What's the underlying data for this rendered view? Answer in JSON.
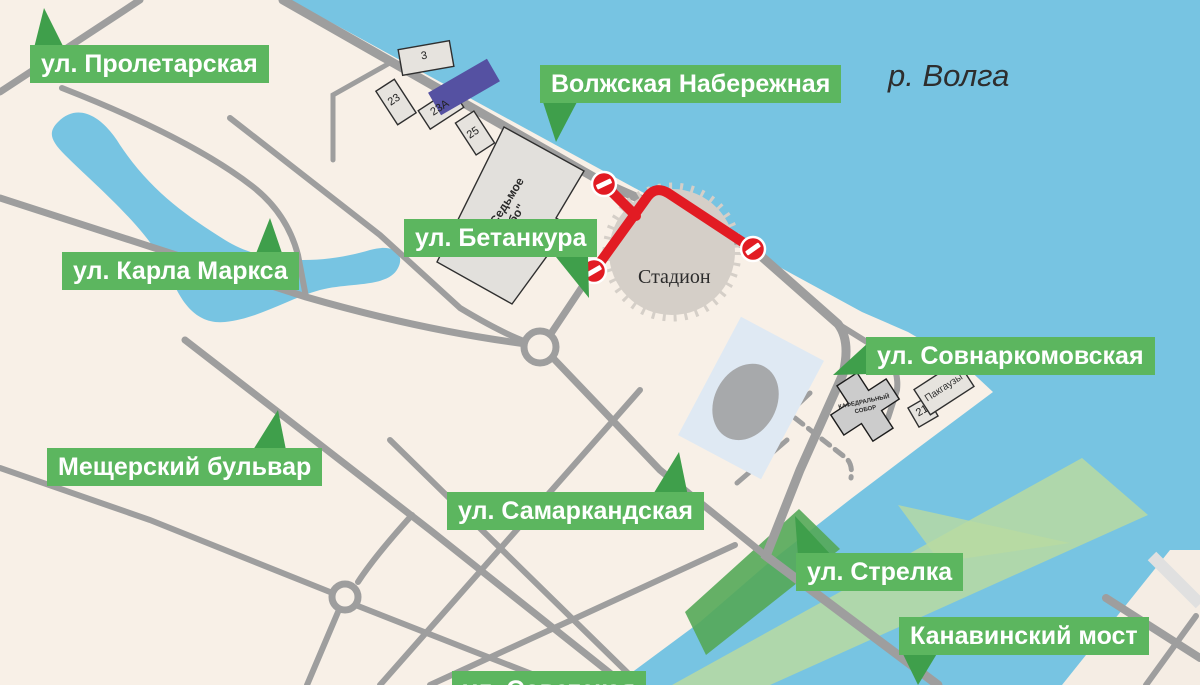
{
  "map": {
    "water_label": "р. Волга",
    "street_labels": [
      {
        "id": "proletarskaya",
        "text": "ул. Пролетарская"
      },
      {
        "id": "volzhskaya",
        "text": "Волжская Набережная"
      },
      {
        "id": "karla_marksa",
        "text": "ул. Карла Маркса"
      },
      {
        "id": "betankura",
        "text": "ул. Бетанкура"
      },
      {
        "id": "sovnarkomovskaya",
        "text": "ул. Совнаркомовская"
      },
      {
        "id": "meshchersky",
        "text": "Мещерский бульвар"
      },
      {
        "id": "samarkandskaya",
        "text": "ул. Самаркандская"
      },
      {
        "id": "strelka",
        "text": "ул. Стрелка"
      },
      {
        "id": "kanavinsky",
        "text": "Канавинский мост"
      },
      {
        "id": "sovetskaya",
        "text": "ул. Советская"
      }
    ],
    "poi": {
      "stadium": "Стадион",
      "mall_line1": "ТЦ \"Седьмое",
      "mall_line2": "небо\"",
      "cathedral_line1": "КАФЕДРАЛЬНЫЙ",
      "cathedral_line2": "СОБОР",
      "warehouses": "Пакгаузы"
    },
    "building_numbers": [
      "3",
      "23",
      "23А",
      "25",
      "21"
    ],
    "legend": {
      "closed_route_meaning": "закрытый проезд (знаки «въезд запрещён»)"
    },
    "colors": {
      "water": "#77c4e2",
      "land": "#f8f0e7",
      "road": "#9e9e9e",
      "label_green": "#5cb65f",
      "pointer_green": "#3f9f4b",
      "closure_red": "#e21b23",
      "stadium_gray": "#d5cfc8",
      "building_fill": "#e6e3de",
      "building_stroke": "#2f2f2f",
      "mall_fill": "#e2e0dc",
      "purple_building": "#5551a2",
      "band_light_green": "#b9dba1",
      "band_dark_green": "#54a958",
      "pond_rect": "#dfe9f3",
      "pond_ellipse": "#a7a9ab"
    }
  }
}
